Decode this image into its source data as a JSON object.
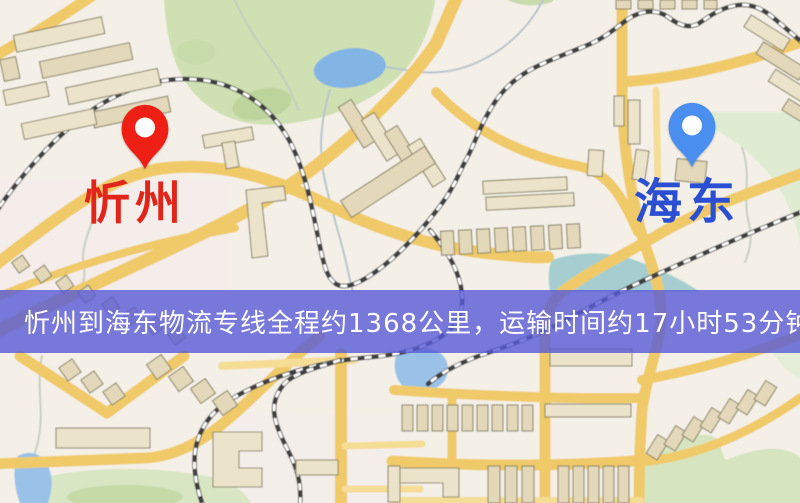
{
  "app": {
    "type": "logistics-route-map",
    "title": "忻州到海东物流专线地图"
  },
  "markers": {
    "origin": {
      "label": "忻州",
      "icon": "location-pin-icon",
      "pin_color": "#ee2015",
      "label_color": "#e1251b"
    },
    "destination": {
      "label": "海东",
      "icon": "location-pin-icon",
      "pin_color": "#4a8ef0",
      "label_color": "#2b4fd2"
    }
  },
  "banner": {
    "text": "忻州到海东物流专线全程约1368公里，运输时间约17小时53分钟.",
    "origin": "忻州",
    "destination": "海东",
    "distance_km": "1368",
    "duration": "17小时53分钟",
    "background_color": "#585ad6",
    "text_color": "#ffffff"
  },
  "map_style": {
    "background": "#f4f0e8",
    "road_color": "#f0ca68",
    "park_color": "#cfe0b2",
    "water_color": "#82b4e4",
    "building_color": "#ece4ca",
    "railway_color": "#3f3f3f"
  }
}
